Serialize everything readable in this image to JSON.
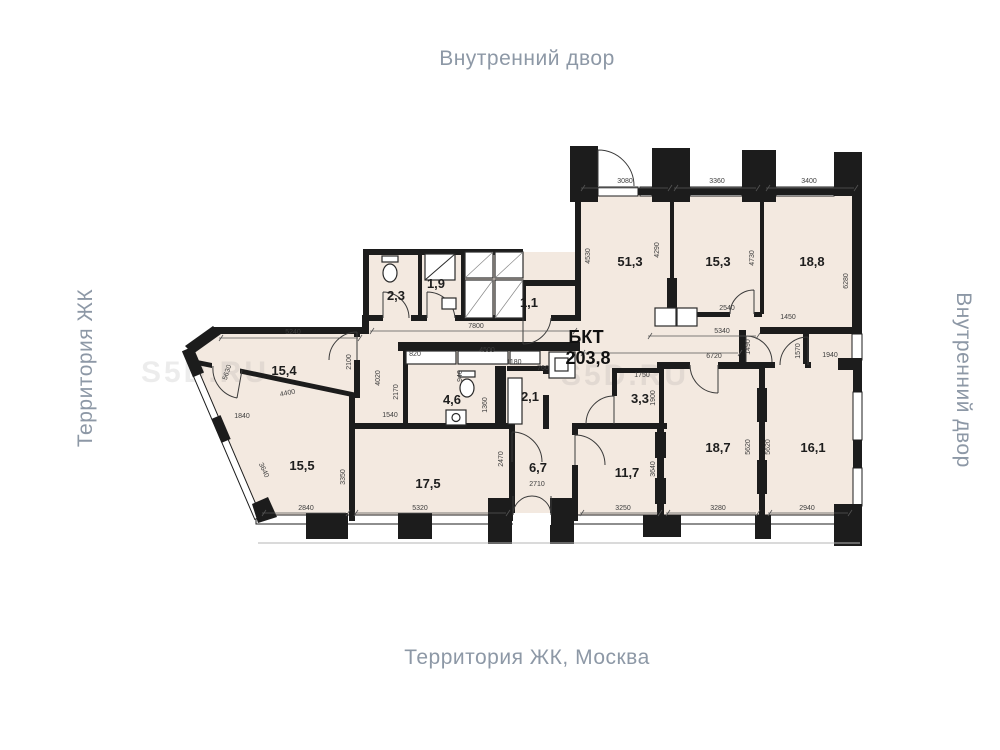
{
  "context_labels": {
    "top": "Внутренний двор",
    "bottom": "Территория ЖК, Москва",
    "left": "Территория ЖК",
    "right": "Внутренний двор"
  },
  "plan": {
    "title": {
      "name": "БКТ",
      "area": "203,8"
    },
    "colors": {
      "floor": "#f3e9e0",
      "wall": "#1c1c1c",
      "dim_text": "#3d3d3d",
      "context_text": "#8d98a6"
    },
    "rooms": [
      {
        "label": "51,3",
        "x": 630,
        "y": 266
      },
      {
        "label": "15,3",
        "x": 718,
        "y": 266
      },
      {
        "label": "18,8",
        "x": 812,
        "y": 266
      },
      {
        "label": "2,3",
        "x": 396,
        "y": 300
      },
      {
        "label": "1,9",
        "x": 436,
        "y": 288
      },
      {
        "label": "1,1",
        "x": 529,
        "y": 307
      },
      {
        "label": "15,4",
        "x": 284,
        "y": 375
      },
      {
        "label": "4,6",
        "x": 452,
        "y": 404
      },
      {
        "label": "2,1",
        "x": 530,
        "y": 401
      },
      {
        "label": "3,3",
        "x": 640,
        "y": 403
      },
      {
        "label": "15,5",
        "x": 302,
        "y": 470
      },
      {
        "label": "17,5",
        "x": 428,
        "y": 488
      },
      {
        "label": "6,7",
        "x": 538,
        "y": 472
      },
      {
        "label": "11,7",
        "x": 627,
        "y": 477
      },
      {
        "label": "18,7",
        "x": 718,
        "y": 452
      },
      {
        "label": "16,1",
        "x": 813,
        "y": 452
      }
    ],
    "dimensions": [
      {
        "label": "3080",
        "x": 625,
        "y": 183,
        "r": 0
      },
      {
        "label": "3360",
        "x": 717,
        "y": 183,
        "r": 0
      },
      {
        "label": "3400",
        "x": 809,
        "y": 183,
        "r": 0
      },
      {
        "label": "4530",
        "x": 590,
        "y": 256,
        "r": -90
      },
      {
        "label": "4290",
        "x": 659,
        "y": 250,
        "r": -90
      },
      {
        "label": "4730",
        "x": 754,
        "y": 258,
        "r": -90
      },
      {
        "label": "6280",
        "x": 848,
        "y": 281,
        "r": -90
      },
      {
        "label": "2540",
        "x": 727,
        "y": 310,
        "r": 0
      },
      {
        "label": "1450",
        "x": 788,
        "y": 319,
        "r": 0
      },
      {
        "label": "5340",
        "x": 722,
        "y": 333,
        "r": 0
      },
      {
        "label": "6720",
        "x": 714,
        "y": 358,
        "r": 0
      },
      {
        "label": "1490",
        "x": 750,
        "y": 347,
        "r": -90
      },
      {
        "label": "1570",
        "x": 800,
        "y": 351,
        "r": -90
      },
      {
        "label": "1940",
        "x": 830,
        "y": 357,
        "r": 0
      },
      {
        "label": "7800",
        "x": 476,
        "y": 328,
        "r": 0
      },
      {
        "label": "5240",
        "x": 293,
        "y": 334,
        "r": 0
      },
      {
        "label": "5630",
        "x": 229,
        "y": 373,
        "r": -72
      },
      {
        "label": "2100",
        "x": 351,
        "y": 362,
        "r": -90
      },
      {
        "label": "4020",
        "x": 380,
        "y": 378,
        "r": -90
      },
      {
        "label": "4400",
        "x": 288,
        "y": 395,
        "r": -12
      },
      {
        "label": "2170",
        "x": 398,
        "y": 392,
        "r": -90
      },
      {
        "label": "1840",
        "x": 242,
        "y": 418,
        "r": 0
      },
      {
        "label": "1540",
        "x": 390,
        "y": 417,
        "r": 0
      },
      {
        "label": "820",
        "x": 415,
        "y": 356,
        "r": 0
      },
      {
        "label": "4500",
        "x": 487,
        "y": 352,
        "r": 0
      },
      {
        "label": "1180",
        "x": 514,
        "y": 364,
        "r": 0
      },
      {
        "label": "760",
        "x": 543,
        "y": 370,
        "r": 0
      },
      {
        "label": "940",
        "x": 462,
        "y": 376,
        "r": -90
      },
      {
        "label": "1360",
        "x": 487,
        "y": 405,
        "r": -90
      },
      {
        "label": "3640",
        "x": 262,
        "y": 471,
        "r": 65
      },
      {
        "label": "3350",
        "x": 345,
        "y": 477,
        "r": -90
      },
      {
        "label": "2840",
        "x": 306,
        "y": 510,
        "r": 0
      },
      {
        "label": "5320",
        "x": 420,
        "y": 510,
        "r": 0
      },
      {
        "label": "2470",
        "x": 503,
        "y": 459,
        "r": -90
      },
      {
        "label": "2710",
        "x": 537,
        "y": 486,
        "r": 0
      },
      {
        "label": "1750",
        "x": 642,
        "y": 377,
        "r": 0
      },
      {
        "label": "1900",
        "x": 655,
        "y": 398,
        "r": -90
      },
      {
        "label": "3640",
        "x": 655,
        "y": 469,
        "r": -90
      },
      {
        "label": "3250",
        "x": 623,
        "y": 510,
        "r": 0
      },
      {
        "label": "3280",
        "x": 718,
        "y": 510,
        "r": 0
      },
      {
        "label": "2940",
        "x": 807,
        "y": 510,
        "r": 0
      },
      {
        "label": "5620",
        "x": 750,
        "y": 447,
        "r": -90
      },
      {
        "label": "5620",
        "x": 770,
        "y": 447,
        "r": -90
      }
    ],
    "watermarks": [
      {
        "label": "S5D.RU",
        "x": 205,
        "y": 382
      },
      {
        "label": "S5D.RU",
        "x": 625,
        "y": 385
      }
    ]
  }
}
